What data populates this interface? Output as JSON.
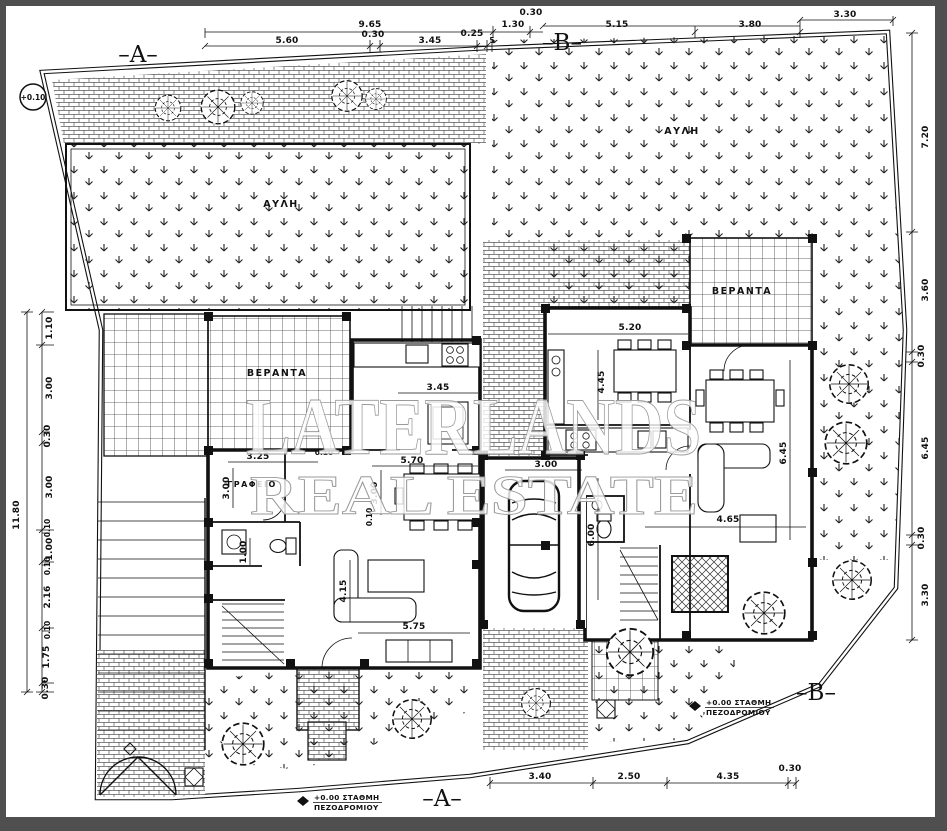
{
  "drawing": {
    "plot_level_marker": "+0.10",
    "sections": {
      "a": "–A–",
      "b": "–B–"
    },
    "rooms": {
      "yard": "ΑΥΛΗ",
      "veranda": "ΒΕΡΑΝΤΑ",
      "office": "ΓΡΑΦΕΙΟ"
    },
    "levels": {
      "sidewalk_line1": "+0.00  ΣΤΑΘΜΗ",
      "sidewalk_line2": "ΠΕΖΟΔΡΟΜΙΟΥ"
    },
    "watermark": {
      "line1": "LATERLANDS",
      "line2": "REAL ESTATE"
    },
    "dims": {
      "top": [
        "9.65",
        "5.60",
        "0.30",
        "3.45",
        "0.25",
        "5",
        "1.30",
        "0.30",
        "5.15",
        "3.80",
        "3.30"
      ],
      "left": [
        "1.10",
        "3.00",
        "0.30",
        "3.00",
        "0.10",
        "1.00",
        "0.10",
        "2.16",
        "0.10",
        "1.75",
        "0.30",
        "11.80"
      ],
      "right": [
        "7.20",
        "3.60",
        "0.30",
        "6.45",
        "0.30",
        "3.30"
      ],
      "bottom": [
        "3.40",
        "2.50",
        "4.35",
        "0.30"
      ],
      "interior": [
        "3.45",
        "0.10",
        "3.25",
        "3.00",
        "5.70",
        "3.00",
        "0.10",
        "1.00",
        "4.15",
        "5.75",
        "3.00",
        "6.00",
        "5.20",
        "4.45",
        "6.45",
        "4.65"
      ]
    }
  }
}
